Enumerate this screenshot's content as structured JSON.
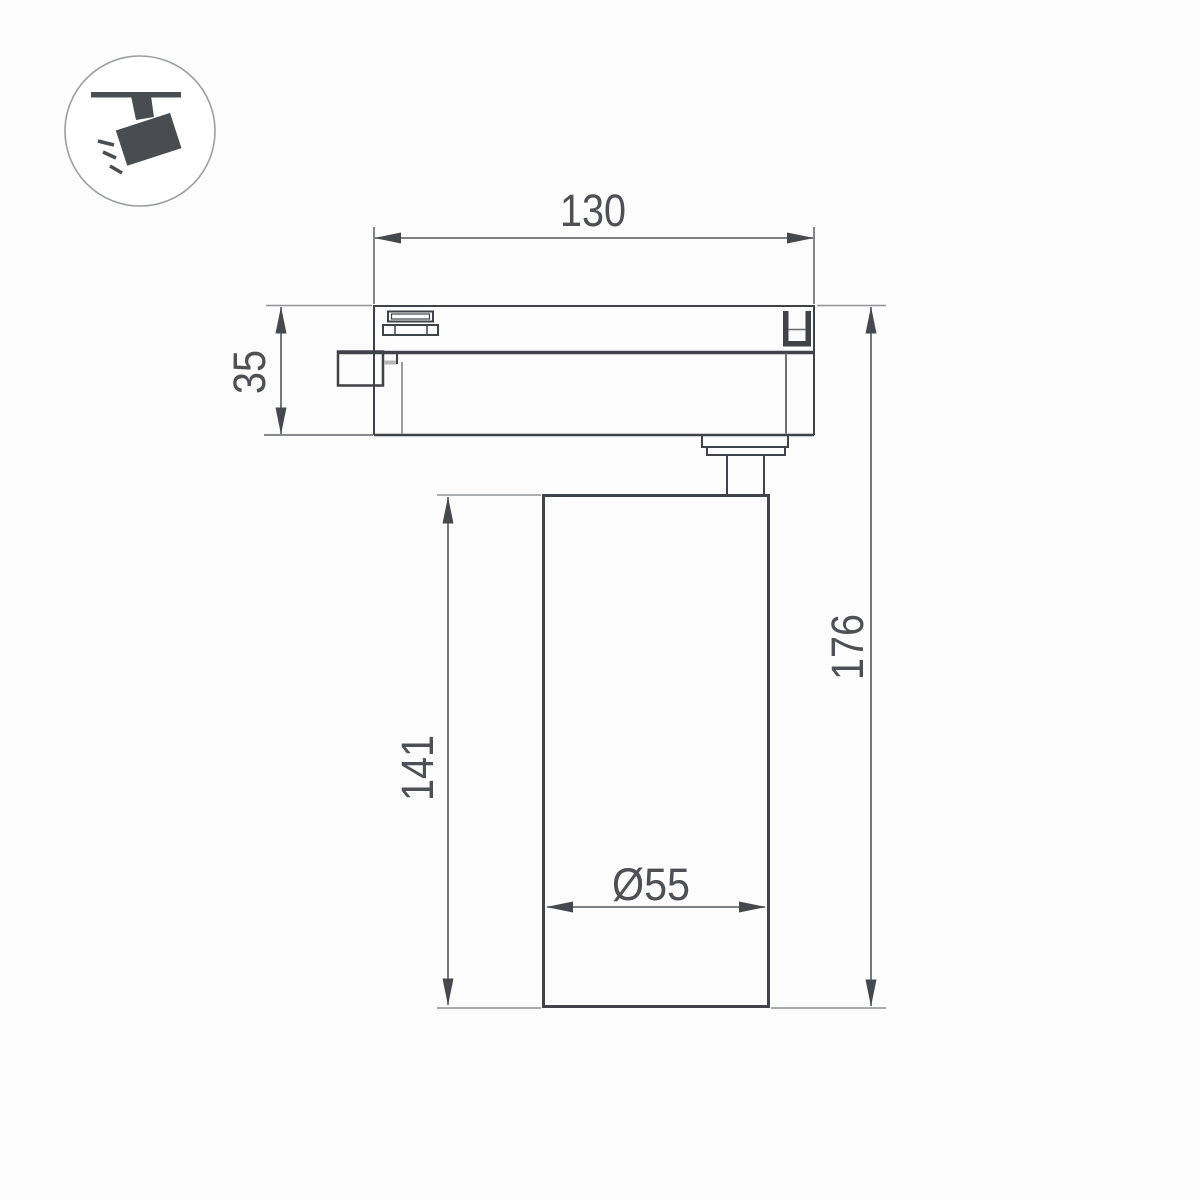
{
  "page": {
    "background_color": "#fcfcfc",
    "description_label": "Track spotlight dimension drawing"
  },
  "icon_legend": {
    "name": "track-mounted-spotlight",
    "fill_color": "#484d52",
    "ring_color": "#9b9ea1"
  },
  "drawing": {
    "line_color": "#3f4246",
    "dim_color": "#55585b",
    "extension_color": "#8f9294",
    "text_color": "#4d5054",
    "dimensions": {
      "track_adapter_width": "130",
      "track_adapter_height": "35",
      "body_height": "141",
      "total_height": "176",
      "body_diameter": "Ø55"
    }
  }
}
